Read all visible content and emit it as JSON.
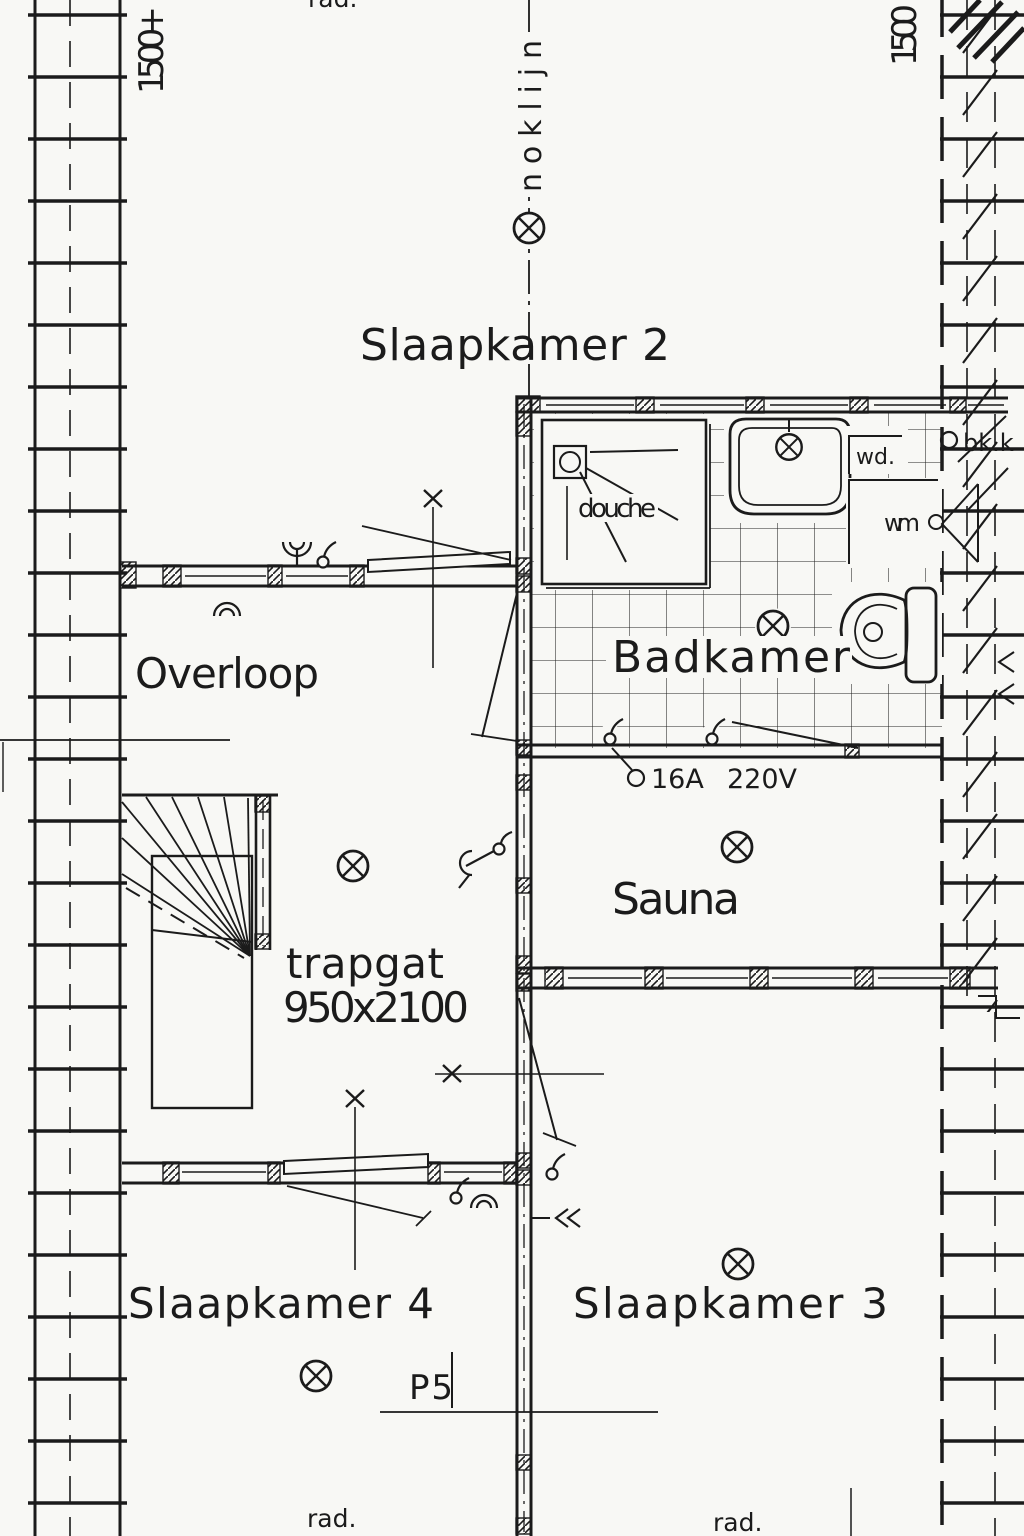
{
  "meta": {
    "document_type": "architectural floor plan (scanned blueprint, upper floor)",
    "language": "Dutch"
  },
  "colors": {
    "paper": "#f8f8f5",
    "ink": "#1b1b1b"
  },
  "labels": {
    "room_bedroom2": "Slaapkamer 2",
    "room_bedroom3": "Slaapkamer 3",
    "room_bedroom4": "Slaapkamer 4",
    "room_landing": "Overloop",
    "room_bathroom": "Badkamer",
    "room_sauna": "Sauna",
    "shower": "douche",
    "stair_opening": "trapgat",
    "stair_size": "950x2100",
    "ridge_line": "noklijn",
    "level_left": "1500+",
    "level_right": "1500",
    "rad_top": "rad.",
    "rad_bottom_left": "rad.",
    "rad_bottom_right": "rad.",
    "amps": "16A",
    "volts": "220V",
    "washer": "wm",
    "dryer": "wd.",
    "bk_k": "bk.k",
    "section_mark": "P5"
  },
  "symbols": {
    "ceiling_light": "circle-with-diagonal-cross",
    "socket": "small-open-circle",
    "pull_switch": "circle-with-cord",
    "two_way_switch": "arc-line-circle",
    "vent_valve": "nested-arcs",
    "door_swing": "diagonal-leaf-line",
    "wall_pier": "diagonal-hatch-block",
    "masonry_wall": "ladder-hatch-strip",
    "roof_plane": "diagonal-hatch-band"
  }
}
